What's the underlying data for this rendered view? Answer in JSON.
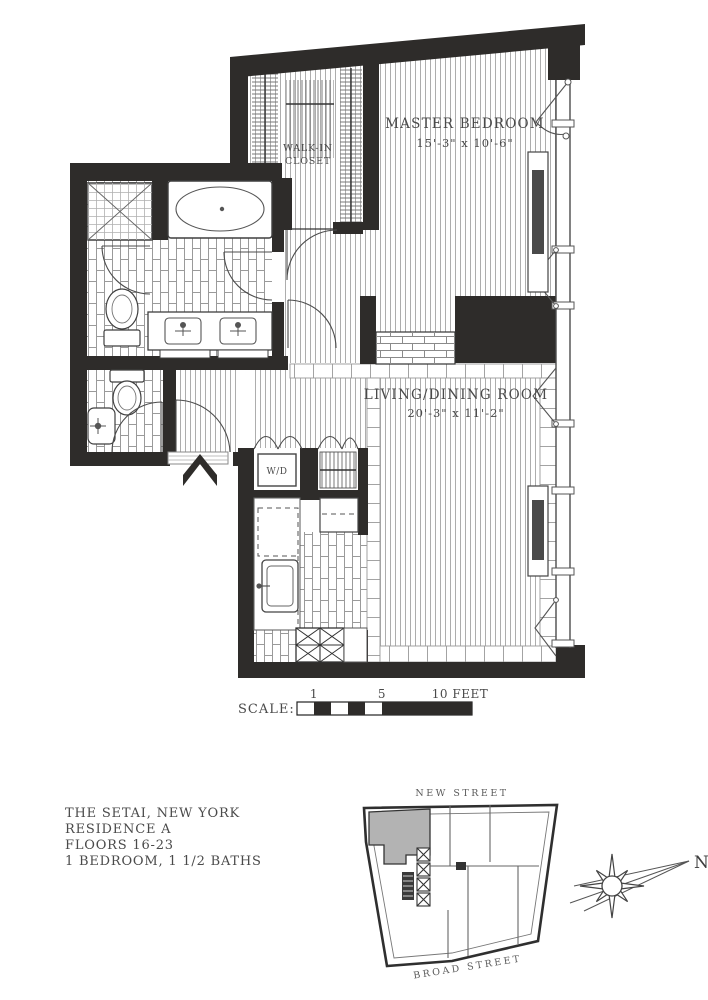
{
  "title_block": {
    "lines": [
      "THE SETAI, NEW YORK",
      "RESIDENCE A",
      "FLOORS 16-23",
      "1 BEDROOM, 1 1/2 BATHS"
    ]
  },
  "rooms": {
    "master_bedroom": {
      "name": "MASTER BEDROOM",
      "dims": "15'-3\" x 10'-6\""
    },
    "living_dining": {
      "name": "LIVING/DINING ROOM",
      "dims": "20'-3\" x 11'-2\""
    },
    "walk_in_closet": {
      "name_line1": "WALK-IN",
      "name_line2": "CLOSET"
    },
    "laundry": {
      "label": "W/D"
    }
  },
  "scale_bar": {
    "label": "SCALE:",
    "ticks": [
      "1",
      "5",
      "10 FEET"
    ]
  },
  "key_plan": {
    "street_top": "NEW STREET",
    "street_bottom": "BROAD STREET"
  },
  "compass": {
    "north": "N"
  },
  "colors": {
    "wall": "#2e2c2a",
    "floor_line": "#adadad",
    "tile_line": "#9a9a9a",
    "highlighted_unit": "#b3b3b3",
    "label_text": "#4a4a4a",
    "background": "#ffffff"
  }
}
